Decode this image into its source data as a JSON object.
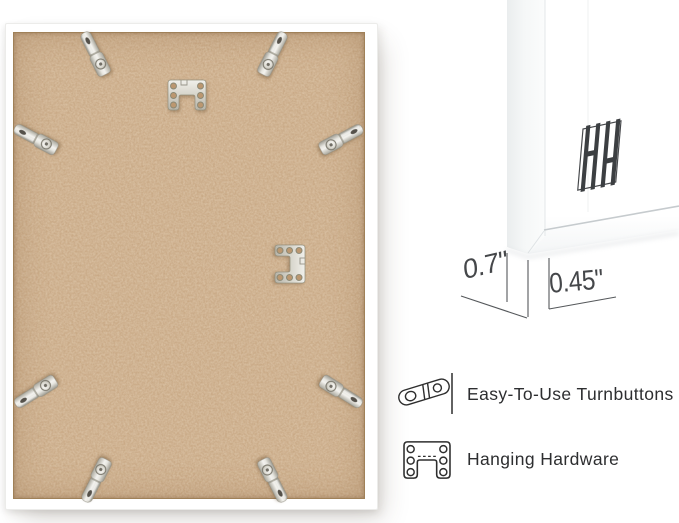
{
  "product_photo": {
    "subject": "back of white picture frame with MDF backing board",
    "turnbutton_count": 8,
    "hanging_hardware_count": 2
  },
  "corner_detail": {
    "depth": "0.7\"",
    "face_width": "0.45\""
  },
  "features": [
    {
      "icon": "turnbutton-icon",
      "label": "Easy-To-Use Turnbuttons"
    },
    {
      "icon": "hanging-hardware-icon",
      "label": "Hanging Hardware"
    }
  ],
  "icons": {
    "brand_logo": "brand-logo-hh-icon"
  },
  "colors": {
    "background": "#ffffff",
    "frame": "#ffffff",
    "mdf_board": "#c7a47e",
    "metal": "#d9d7cf",
    "line_art": "#2e2e2e",
    "dimension_text": "#45474a"
  }
}
